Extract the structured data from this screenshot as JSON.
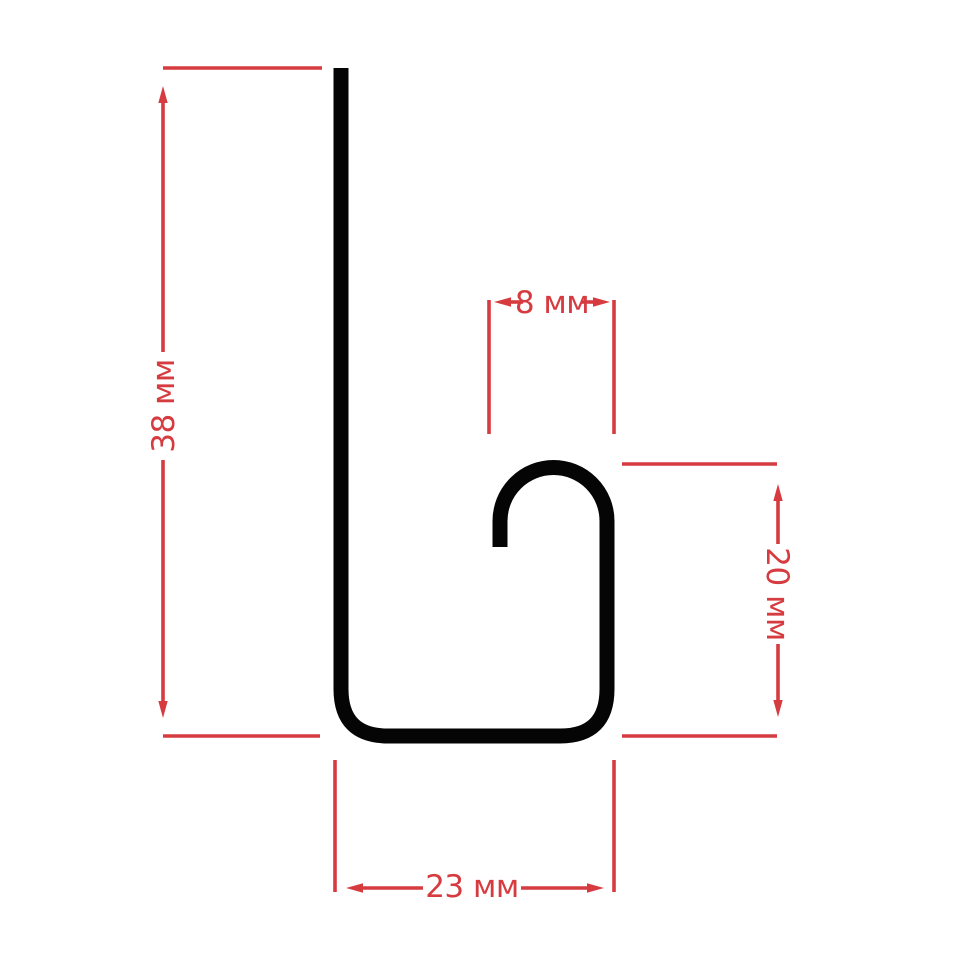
{
  "diagram": {
    "kind": "profile-cross-section",
    "unit": "мм",
    "colors": {
      "profile": "#050505",
      "dimension": "#d63b40",
      "background": "#ffffff"
    },
    "profile_shape": "j-channel-hook",
    "arrow_style": "slim-triangle",
    "dimensions": {
      "overall_height": {
        "label": "38 мм",
        "value": 38,
        "orientation": "vertical",
        "side": "left"
      },
      "hook_width": {
        "label": "8 мм",
        "value": 8,
        "orientation": "horizontal",
        "side": "top-middle"
      },
      "hook_height": {
        "label": "20 мм",
        "value": 20,
        "orientation": "vertical",
        "side": "right"
      },
      "overall_width": {
        "label": "23 мм",
        "value": 23,
        "orientation": "horizontal",
        "side": "bottom"
      }
    }
  }
}
